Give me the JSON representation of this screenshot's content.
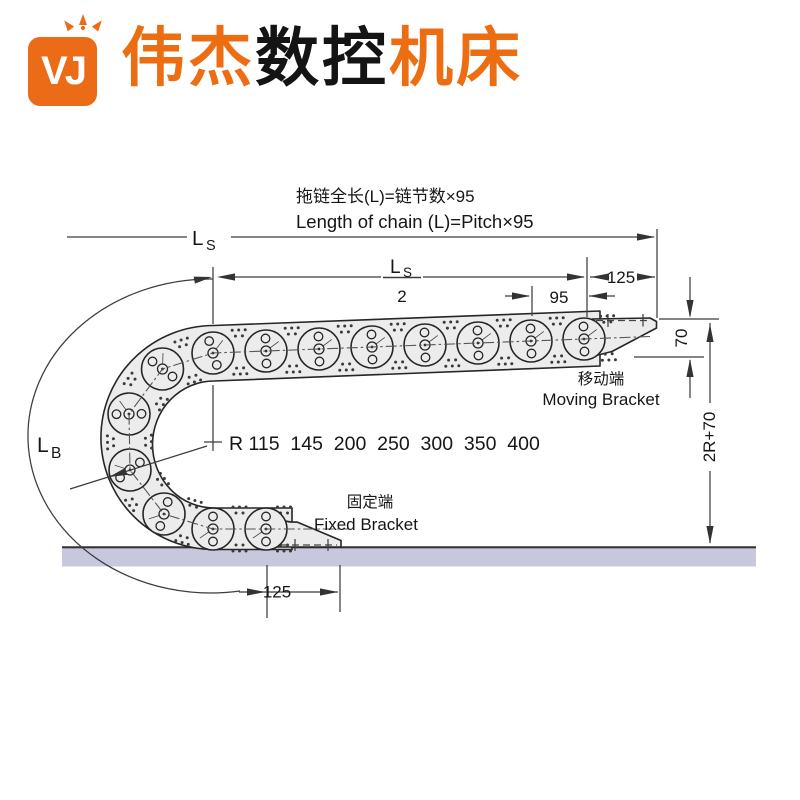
{
  "brand": {
    "logo_text": "VJ",
    "orange": "#ec6b17",
    "title_parts": [
      {
        "text": "伟杰",
        "color": "#ed6d12"
      },
      {
        "text": "数控",
        "color": "#141414"
      },
      {
        "text": "机床",
        "color": "#ed6d12"
      }
    ]
  },
  "diagram": {
    "formula_cn": "拖链全长(L)=链节数×95",
    "formula_en": "Length of chain (L)=Pitch×95",
    "labels": {
      "ls_main": "L",
      "ls_sub": "S",
      "ls2_main": "L",
      "ls2_sub": "S",
      "ls2_denominator": "2",
      "lb_main": "L",
      "lb_sub": "B",
      "dim_125_top": "125",
      "dim_95": "95",
      "dim_70": "70",
      "dim_2r_70": "2R+70",
      "dim_125_bottom": "125",
      "radius_options": "R 115  145  200  250  300  350  400",
      "moving_bracket_cn": "移动端",
      "moving_bracket_en": "Moving Bracket",
      "fixed_bracket_cn": "固定端",
      "fixed_bracket_en": "Fixed Bracket"
    },
    "colors": {
      "line": "#3c3c3c",
      "text": "#161616",
      "chain_fill": "#ececec",
      "chain_stroke": "#262626",
      "ground_fill": "#c7c8de"
    }
  }
}
